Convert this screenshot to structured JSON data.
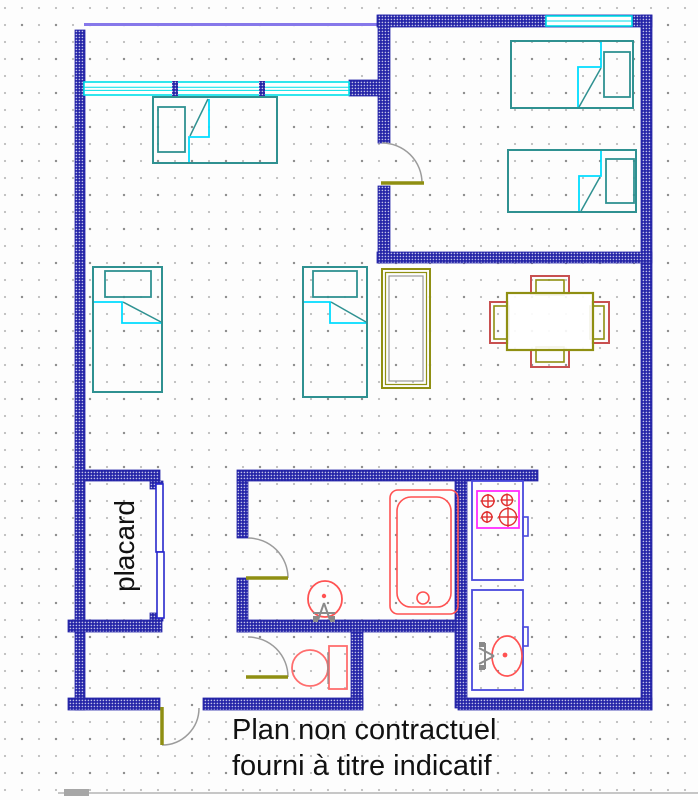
{
  "labels": {
    "closet": "placard",
    "caption_line1": "Plan non contractuel",
    "caption_line2": "fourni à titre indicatif"
  },
  "colors": {
    "wall": "#2525a8",
    "window": "#00dfe8",
    "balcony": "#8678ea",
    "bed_frame": "#2f9191",
    "bed_fold": "#00dcff",
    "olive": "#8f8f12",
    "wardrobe_inner": "#9a9a9a",
    "chair_red": "#c85050",
    "fixture_red": "#ff5252",
    "toilet_red": "#ff6e6e",
    "stove_magenta": "#ff2cff",
    "burner_red": "#e03030",
    "cabinet_blue": "#4848dd",
    "closet_door_blue": "#2828cc",
    "door_arc": "#9c9c9c",
    "door_leaf": "#8f8f12",
    "faucet_gray": "#8a8a8a",
    "text": "#111111",
    "scrollbar": "#c6c6c6"
  }
}
